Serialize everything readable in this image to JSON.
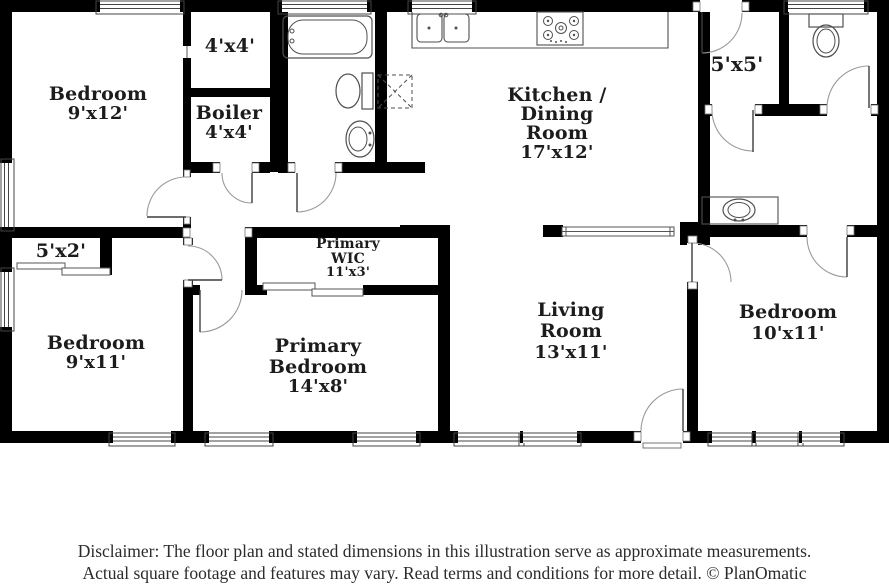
{
  "plan": {
    "rooms": {
      "bedroom_top_left": {
        "name": "Bedroom",
        "dims": "9'x12'"
      },
      "closet_4x4": {
        "dims": "4'x4'"
      },
      "boiler": {
        "name": "Boiler",
        "dims": "4'x4'"
      },
      "kitchen_dining": {
        "line1": "Kitchen /",
        "line2": "Dining",
        "line3": "Room",
        "dims": "17'x12'"
      },
      "entry_5x5": {
        "dims": "5'x5'"
      },
      "closet_5x2": {
        "dims": "5'x2'"
      },
      "bedroom_bottom_left": {
        "name": "Bedroom",
        "dims": "9'x11'"
      },
      "primary_wic": {
        "line1": "Primary",
        "line2": "WIC",
        "dims": "11'x3'"
      },
      "primary_bedroom": {
        "line1": "Primary",
        "line2": "Bedroom",
        "dims": "14'x8'"
      },
      "living_room": {
        "line1": "Living",
        "line2": "Room",
        "dims": "13'x11'"
      },
      "bedroom_bottom_right": {
        "name": "Bedroom",
        "dims": "10'x11'"
      }
    },
    "fixtures": [
      "bathtub",
      "toilet",
      "pedestal-sink",
      "double-kitchen-sink",
      "stove-cooktop",
      "appliance-space",
      "toilet",
      "vanity-sink"
    ],
    "colors": {
      "wall": "#000000",
      "label_text": "#1c1c1c",
      "fixture_line": "#4f4f4f",
      "door_arc": "#9a9a9a",
      "window_line": "#444444",
      "background": "#ffffff"
    }
  },
  "footer": {
    "disclaimer_line1": "Disclaimer: The floor plan and stated dimensions in this illustration serve as approximate measurements.",
    "disclaimer_line2": "Actual square footage and features may vary. Read terms and conditions for more detail. © PlanOmatic"
  }
}
